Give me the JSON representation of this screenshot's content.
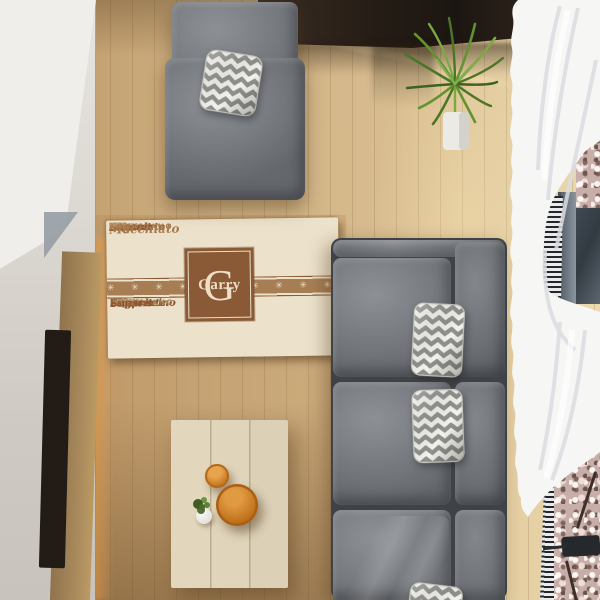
{
  "colors": {
    "floor": "#c9ab7e",
    "rug-bg": "#ece2cb",
    "rug-brown": "#8a5936",
    "rug-band": "#a77e54",
    "rug-cream": "#ecdfc5",
    "rug-text-dark": "#8a5732",
    "rug-text-mid": "#a97c50",
    "rug-text-light": "#c3a078"
  },
  "rug": {
    "monogram_letter": "G",
    "name": "Garry",
    "band": {
      "symbol": "✳",
      "count": 15
    },
    "rows_top": [
      [
        {
          "t": "Sugar",
          "c": "sc"
        },
        {
          "t": "Iced",
          "c": "tn"
        },
        {
          "t": "Dessert",
          "c": "sc"
        },
        {
          "t": "Mocha",
          "c": "tn"
        },
        {
          "t": "Sugar",
          "c": "sc"
        },
        {
          "t": "Breve",
          "c": "tn"
        },
        {
          "t": "Dessert",
          "c": "sc"
        },
        {
          "t": "coffee",
          "c": "tn"
        }
      ],
      [
        {
          "t": "Americano",
          "c": "cap"
        },
        {
          "t": "Coffee",
          "c": "capl"
        },
        {
          "t": "Mocha",
          "c": "tn"
        },
        {
          "t": "Americano",
          "c": "cap"
        },
        {
          "t": "Coffee",
          "c": "capl"
        },
        {
          "t": "Am",
          "c": "cap"
        }
      ],
      [
        {
          "t": "Milk",
          "c": "b"
        },
        {
          "t": "Latte",
          "c": "bl"
        },
        {
          "t": "Cream",
          "c": "sf"
        },
        {
          "t": "con",
          "c": "tn"
        },
        {
          "t": "Milk",
          "c": "b"
        },
        {
          "t": "Latte",
          "c": "bl"
        },
        {
          "t": "Cream",
          "c": "sf"
        },
        {
          "t": "Milk",
          "c": "b"
        }
      ],
      [
        {
          "t": "con Panna",
          "c": "sn"
        },
        {
          "t": "Sugar",
          "c": "sc"
        },
        {
          "t": "Iced",
          "c": "tn"
        },
        {
          "t": "con Panna",
          "c": "sn"
        },
        {
          "t": "Sugar",
          "c": "sc"
        },
        {
          "t": "Latte",
          "c": "tn"
        }
      ],
      [
        {
          "t": "Coffee",
          "c": "sf"
        },
        {
          "t": "Iced",
          "c": "tn"
        },
        {
          "t": "Espresso",
          "c": "sfb"
        },
        {
          "t": "Breve",
          "c": "tn"
        },
        {
          "t": "Milk",
          "c": "b"
        },
        {
          "t": "Espresso",
          "c": "sfb"
        }
      ],
      [
        {
          "t": "Chocolate",
          "c": "sc"
        },
        {
          "t": "coffee",
          "c": "tn"
        },
        {
          "t": "Breve",
          "c": "sn"
        },
        {
          "t": "con Panna",
          "c": "tn"
        },
        {
          "t": "Chocolate",
          "c": "sc"
        },
        {
          "t": "Breve",
          "c": "tn"
        }
      ],
      [
        {
          "t": "Macchiato",
          "c": "scl"
        },
        {
          "t": "Iced",
          "c": "tn"
        },
        {
          "t": "Mocha",
          "c": "sn"
        },
        {
          "t": "Cream",
          "c": "sf"
        },
        {
          "t": "Milk",
          "c": "tn"
        },
        {
          "t": "Americano",
          "c": "cap"
        }
      ]
    ],
    "rows_bottom": [
      [
        {
          "t": "no",
          "c": "tn"
        },
        {
          "t": "Coffee",
          "c": "capl"
        },
        {
          "t": "con Panna",
          "c": "tn"
        },
        {
          "t": "Cappuccino",
          "c": "sc"
        },
        {
          "t": "water",
          "c": "tn"
        },
        {
          "t": "Iced",
          "c": "tn"
        },
        {
          "t": "Cappuccino",
          "c": "sc"
        }
      ],
      [
        {
          "t": "Chocolate",
          "c": "sc"
        },
        {
          "t": "con Panna",
          "c": "tn"
        },
        {
          "t": "Mocha",
          "c": "sn"
        },
        {
          "t": "Iced",
          "c": "tn"
        },
        {
          "t": "Chocolate",
          "c": "sc"
        },
        {
          "t": "Mocha",
          "c": "tn"
        }
      ],
      [
        {
          "t": "Dessert",
          "c": "sc"
        },
        {
          "t": "Mocha",
          "c": "tn"
        },
        {
          "t": "Sugar",
          "c": "sc"
        },
        {
          "t": "Iced",
          "c": "tn"
        },
        {
          "t": "Dessert",
          "c": "sc"
        },
        {
          "t": "coffee",
          "c": "tn"
        },
        {
          "t": "Sugar",
          "c": "sc"
        }
      ],
      [
        {
          "t": "Americano",
          "c": "cap"
        },
        {
          "t": "Coffee",
          "c": "capl"
        },
        {
          "t": "Mocha",
          "c": "tn"
        },
        {
          "t": "Americano",
          "c": "cap"
        },
        {
          "t": "Coffee",
          "c": "capl"
        }
      ],
      [
        {
          "t": "Milk",
          "c": "b"
        },
        {
          "t": "Latte",
          "c": "bl"
        },
        {
          "t": "Cream",
          "c": "sf"
        },
        {
          "t": "con",
          "c": "tn"
        },
        {
          "t": "Milk",
          "c": "b"
        },
        {
          "t": "Latte",
          "c": "bl"
        },
        {
          "t": "Cream",
          "c": "sf"
        }
      ],
      [
        {
          "t": "con Panna",
          "c": "sn"
        },
        {
          "t": "Sugar",
          "c": "sc"
        },
        {
          "t": "Iced",
          "c": "tn"
        },
        {
          "t": "con Panna",
          "c": "sn"
        },
        {
          "t": "Sugar",
          "c": "sc"
        }
      ],
      [
        {
          "t": "Coffee",
          "c": "sf"
        },
        {
          "t": "Espresso",
          "c": "sfb"
        },
        {
          "t": "Breve",
          "c": "tn"
        },
        {
          "t": "Coffee",
          "c": "sf"
        },
        {
          "t": "Espresso",
          "c": "sfb"
        }
      ]
    ]
  }
}
